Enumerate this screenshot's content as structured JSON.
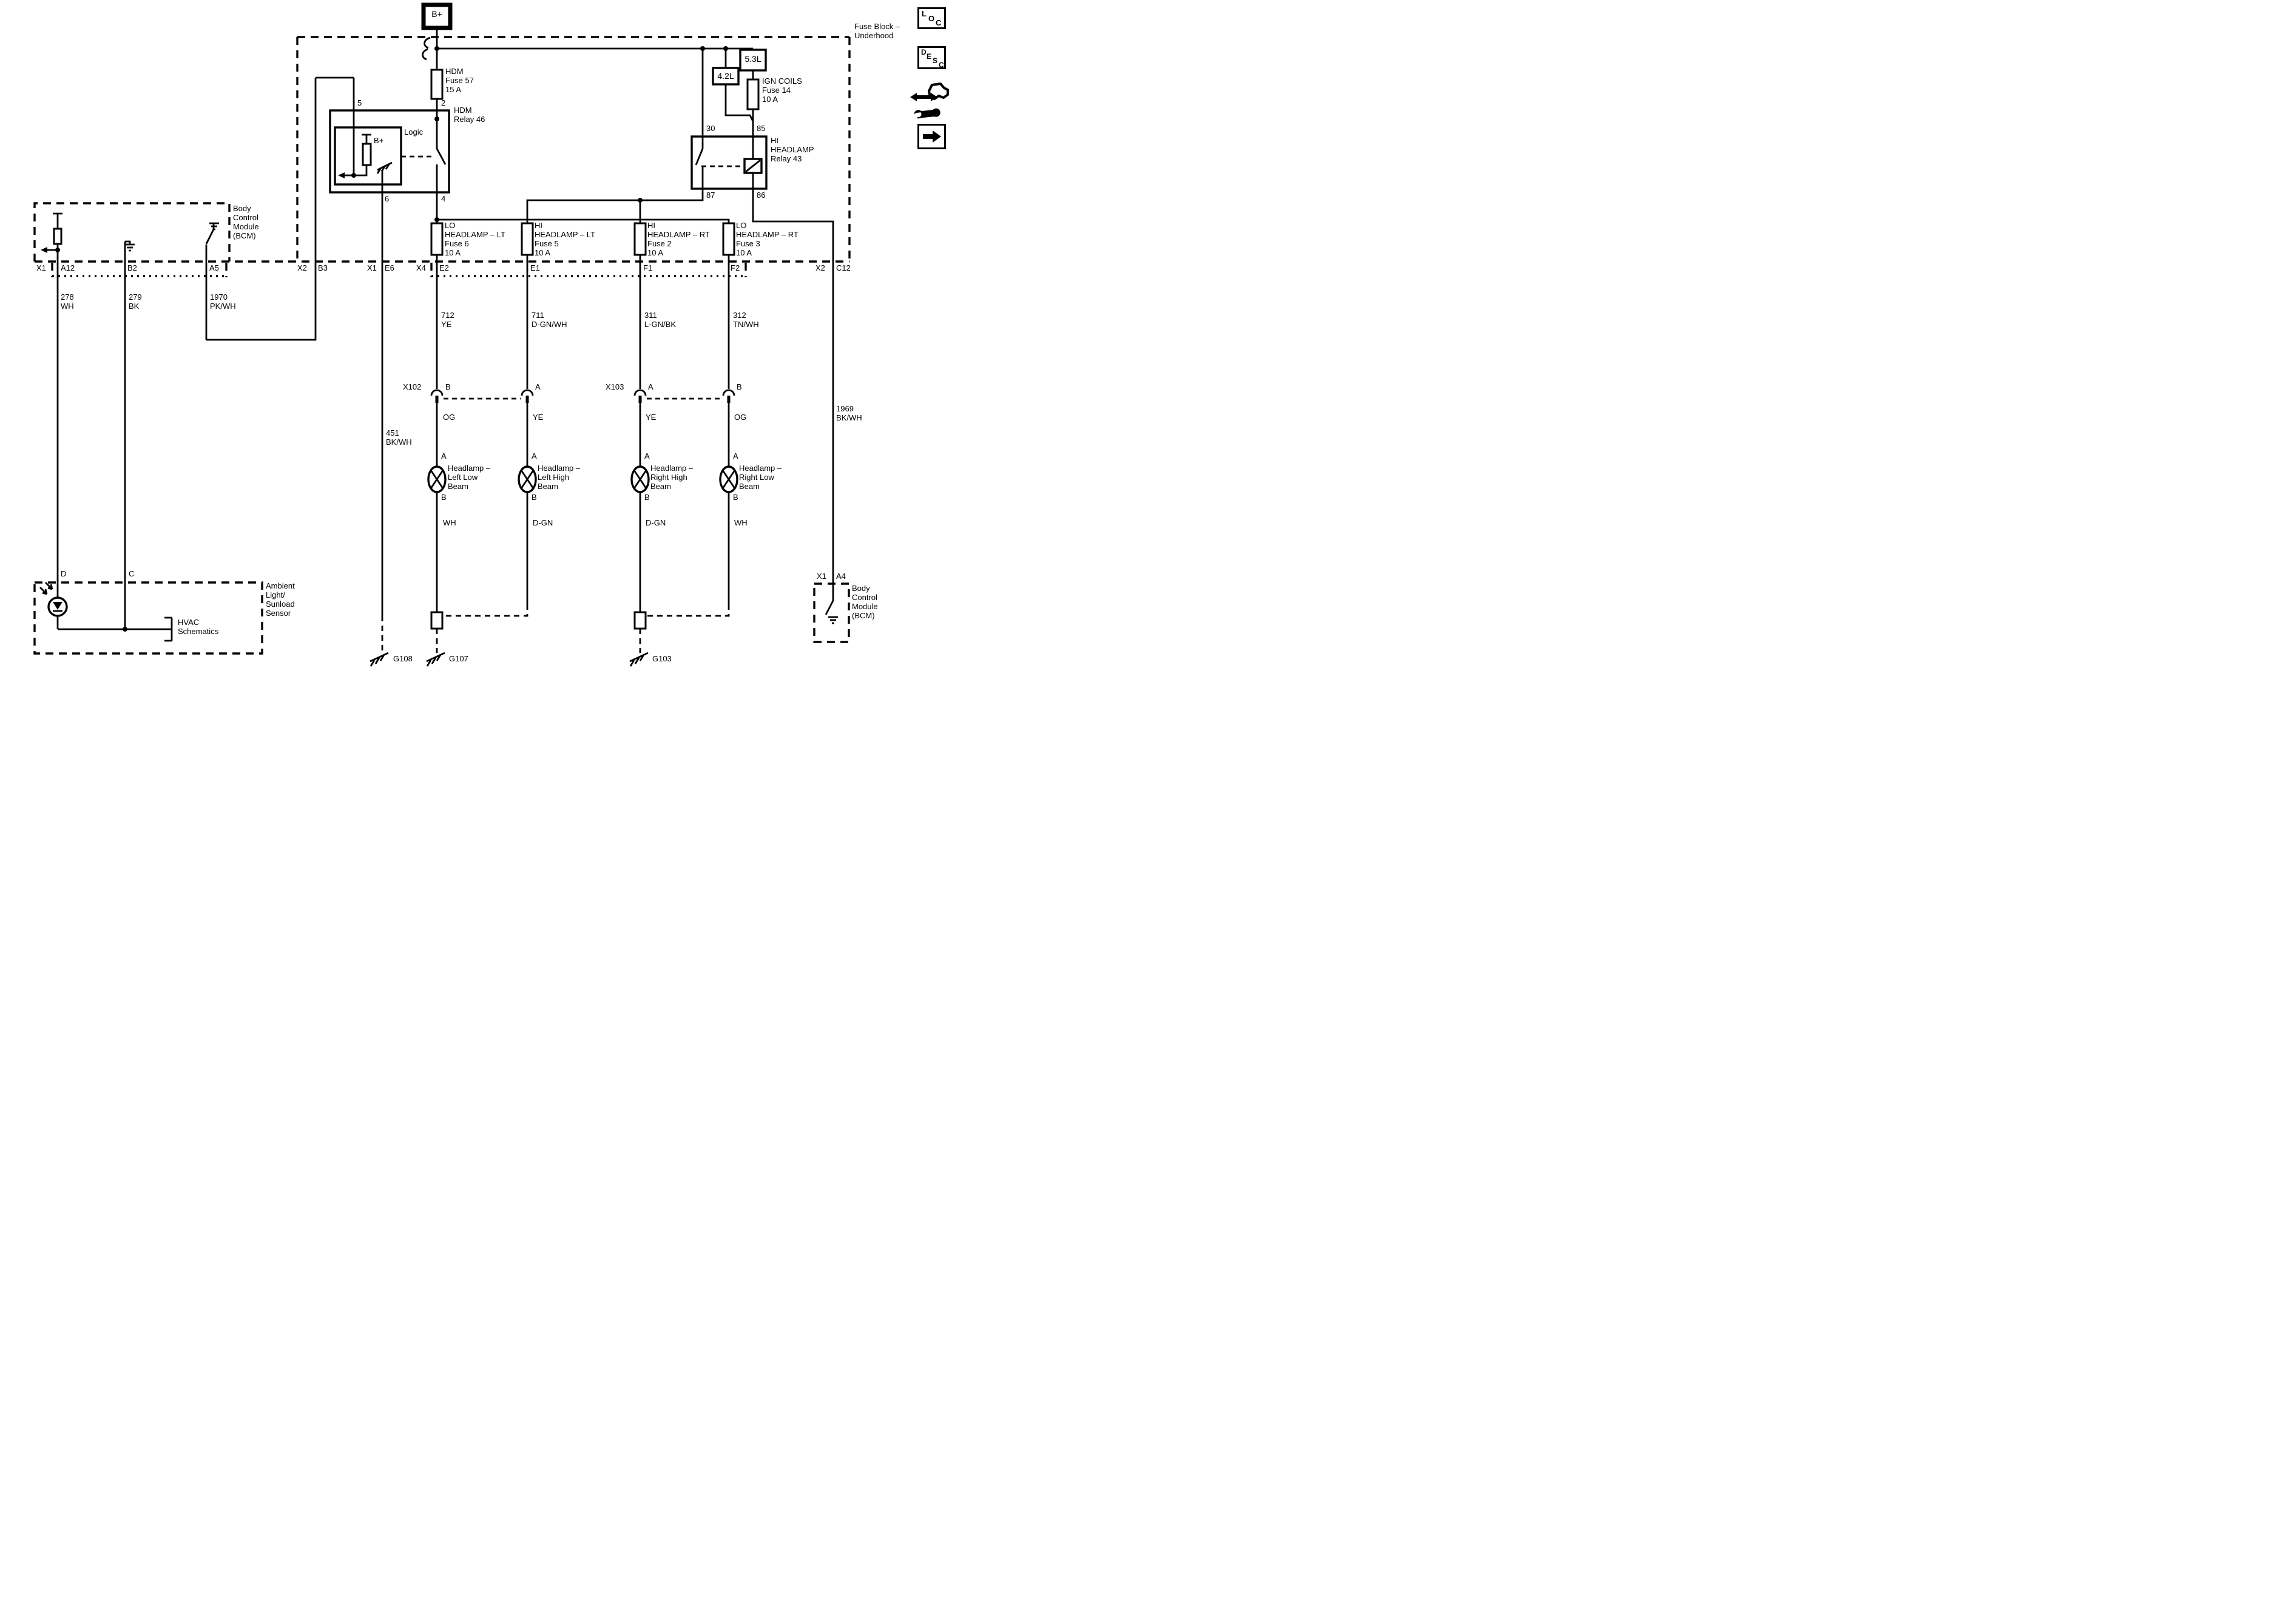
{
  "fuse_block": {
    "label": "Fuse Block –\nUnderhood",
    "b_plus": "B+",
    "hdm_fuse": "HDM\nFuse 57\n15 A",
    "ign_fuse": "IGN COILS\nFuse 14\n10 A",
    "engine_5_3": "5.3L",
    "engine_4_2": "4.2L",
    "hdm_relay": {
      "name": "HDM\nRelay 46",
      "logic": "Logic",
      "b_plus": "B+",
      "pin5": "5",
      "pin2": "2",
      "pin6": "6",
      "pin4": "4"
    },
    "hi_relay": {
      "name": "HI\nHEADLAMP\nRelay 43",
      "pin30": "30",
      "pin85": "85",
      "pin87": "87",
      "pin86": "86"
    },
    "fuses": [
      {
        "label": "LO\nHEADLAMP – LT\nFuse 6\n10 A"
      },
      {
        "label": "HI\nHEADLAMP – LT\nFuse 5\n10 A"
      },
      {
        "label": "HI\nHEADLAMP – RT\nFuse 2\n10 A"
      },
      {
        "label": "LO\nHEADLAMP – RT\nFuse 3\n10 A"
      }
    ]
  },
  "bcm_left": {
    "label": "Body\nControl\nModule\n(BCM)"
  },
  "bcm_right": {
    "label": "Body\nControl\nModule\n(BCM)",
    "x": "X1",
    "pin": "A4"
  },
  "sensor": {
    "label": "Ambient\nLight/\nSunload\nSensor",
    "pin_d": "D",
    "pin_c": "C",
    "hvac_ref": "HVAC\nSchematics"
  },
  "connector_row": {
    "x1_left": "X1",
    "a12": "A12",
    "b2": "B2",
    "a5": "A5",
    "x2_left": "X2",
    "b3": "B3",
    "x1_mid": "X1",
    "e6": "E6",
    "x4": "X4",
    "e2": "E2",
    "e1": "E1",
    "f1": "F1",
    "f2": "F2",
    "x2_right": "X2",
    "c12": "C12"
  },
  "wires": {
    "w278": "278\nWH",
    "w279": "279\nBK",
    "w1970": "1970\nPK/WH",
    "w712": "712\nYE",
    "w711": "711\nD-GN/WH",
    "w311": "311\nL-GN/BK",
    "w312": "312\nTN/WH",
    "w451": "451\nBK/WH",
    "w1969": "1969\nBK/WH"
  },
  "inline_connectors": {
    "x102": "X102",
    "x102_pin_left": "B",
    "x102_pin_right": "A",
    "x103": "X103",
    "x103_pin_left": "A",
    "x103_pin_right": "B"
  },
  "lamps": [
    {
      "pin_top": "A",
      "pin_bottom": "B",
      "name": "Headlamp –\nLeft Low\nBeam",
      "wire_top": "OG",
      "wire_bottom": "WH"
    },
    {
      "pin_top": "A",
      "pin_bottom": "B",
      "name": "Headlamp –\nLeft High\nBeam",
      "wire_top": "YE",
      "wire_bottom": "D-GN"
    },
    {
      "pin_top": "A",
      "pin_bottom": "B",
      "name": "Headlamp –\nRight High\nBeam",
      "wire_top": "YE",
      "wire_bottom": "D-GN"
    },
    {
      "pin_top": "A",
      "pin_bottom": "B",
      "name": "Headlamp –\nRight Low\nBeam",
      "wire_top": "OG",
      "wire_bottom": "WH"
    }
  ],
  "grounds": {
    "g108": "G108",
    "g107": "G107",
    "g103": "G103"
  },
  "toolbar": {
    "loc": [
      "L",
      "O",
      "C"
    ],
    "desc": [
      "D",
      "E",
      "S",
      "C"
    ]
  },
  "colors": {
    "line": "#000000",
    "background": "#ffffff"
  }
}
